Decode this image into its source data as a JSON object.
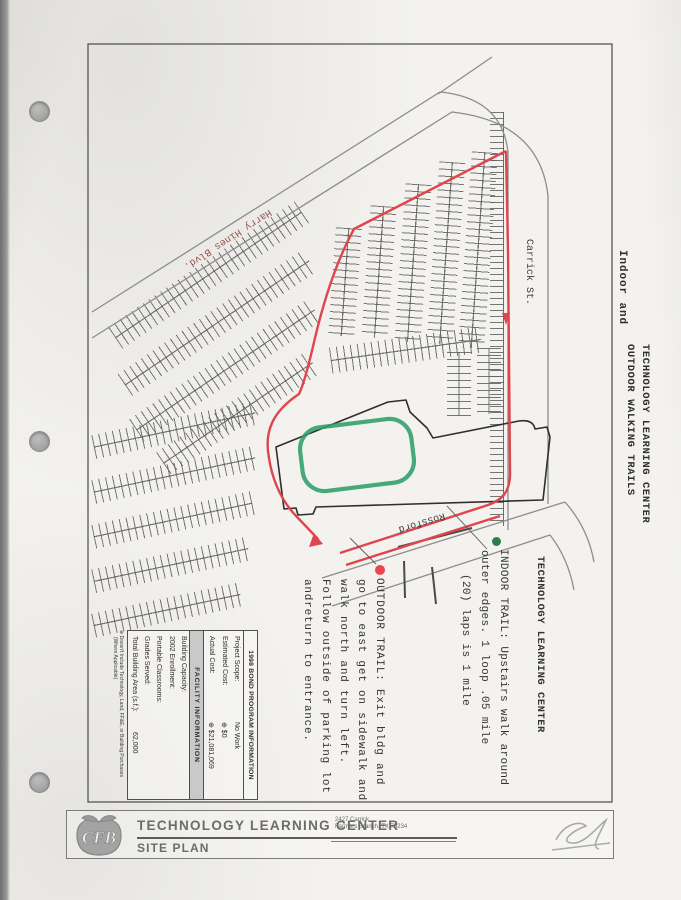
{
  "page": {
    "side_note": "Indoor and",
    "side_title_line1": "TECHNOLOGY LEARNING CENTER",
    "side_title_line2": "OUTDOOR WALKING TRAILS"
  },
  "map": {
    "site_label": "TECHNOLOGY LEARNING CENTER",
    "roads": {
      "harry_hines": "Harry Hines Blvd.",
      "carrick": "Carrick St.",
      "rossford": "Rossford"
    },
    "indoor_trail": {
      "lines": [
        "INDOOR TRAIL:  Upstairs walk around",
        "outer edges.  1 loop .05 mile",
        "(20) laps is 1 mile"
      ]
    },
    "outdoor_trail": {
      "lines": [
        "OUTDOOR TRAIL:  Exit bldg and",
        "go to east get on sidewalk and",
        "walk north and turn left.",
        "Follow outside of parking lot",
        "andreturn to entrance."
      ]
    },
    "colors": {
      "outdoor_trail_red": "#e0444c",
      "indoor_loop_green": "#2f9e6a",
      "indoor_marker_green": "#2e7d4f",
      "road_label_red": "#96524e"
    }
  },
  "info_table": {
    "bond_header": "1998 BOND PROGRAM INFORMATION",
    "bond_rows": [
      {
        "label": "Project Scope:",
        "value": "No Work"
      },
      {
        "label": "Estimated Cost:",
        "value": "⊕ $0"
      },
      {
        "label": "Actual Cost:",
        "value": "⊕ $21,081,069"
      }
    ],
    "facility_header": "FACILITY INFORMATION",
    "facility_rows": [
      {
        "label": "Building Capacity:",
        "value": ""
      },
      {
        "label": "2002 Enrollment:",
        "value": ""
      },
      {
        "label": "Portable Classrooms:",
        "value": ""
      },
      {
        "label": "Grades Served:",
        "value": ""
      },
      {
        "label": "Total Building Area (s.f.):",
        "value": "62,000"
      }
    ],
    "footnote_line1": "⊕ Doesn't Include Technology, Land, FF&E, or Building Purchases",
    "footnote_line2": "(Where Applicable)"
  },
  "title_block": {
    "logo_text": "CFB",
    "title": "TECHNOLOGY LEARNING CENTER",
    "subtitle": "SITE PLAN",
    "address_line1": "2427 Carrick",
    "address_line2": "Farmers Branch, TX  75234"
  }
}
